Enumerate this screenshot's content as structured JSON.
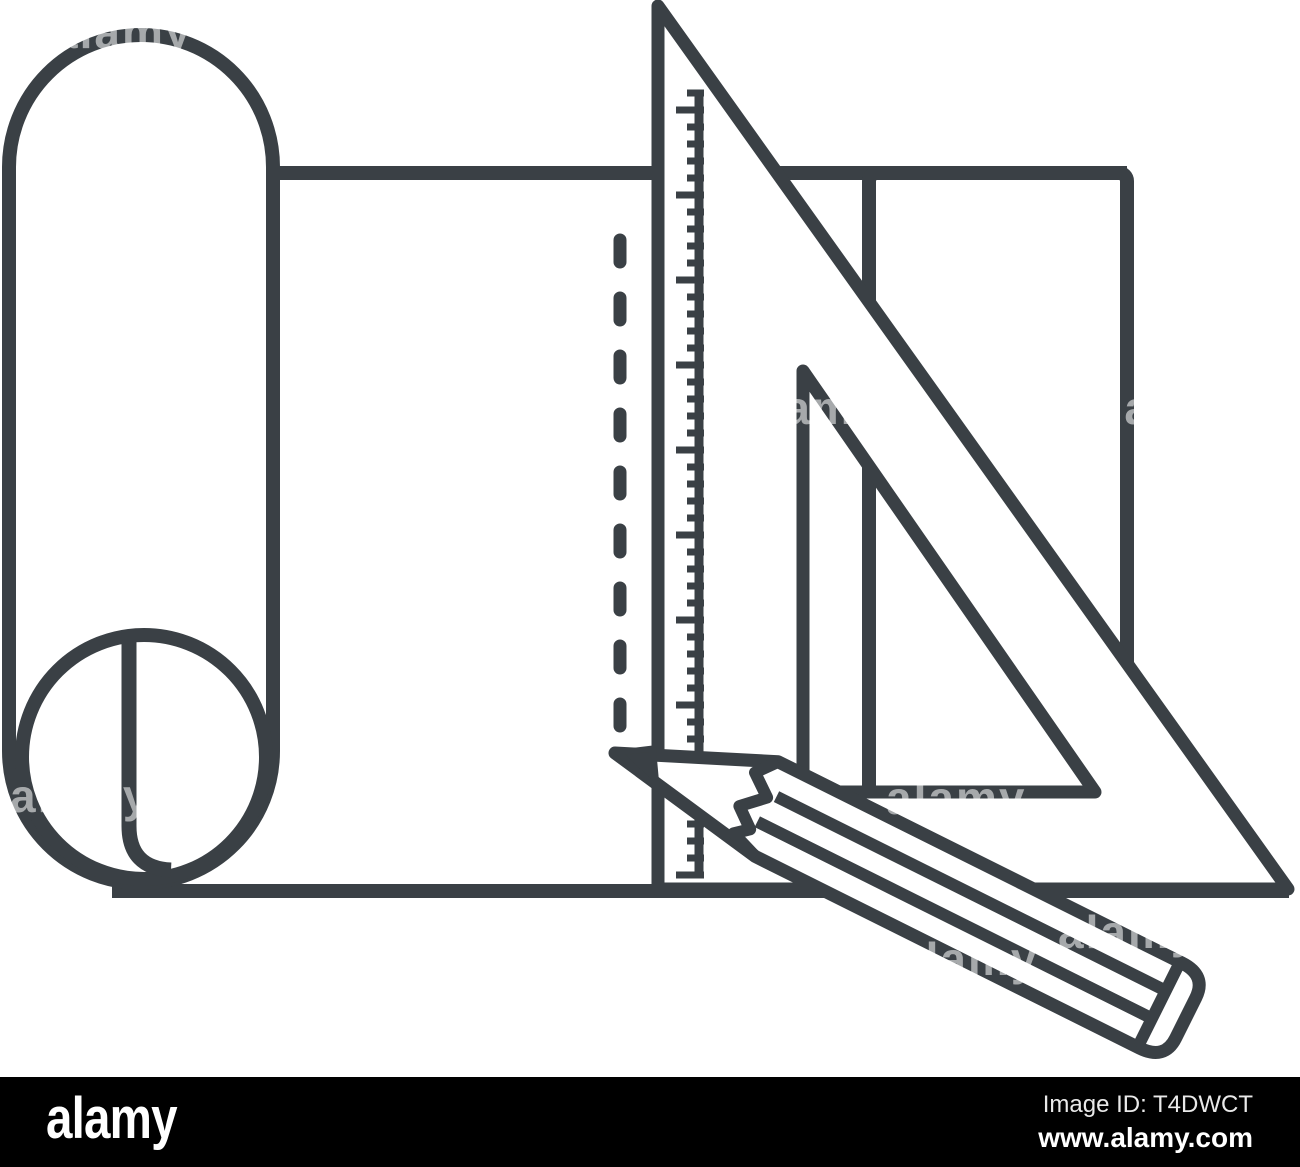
{
  "canvas": {
    "width": 1300,
    "height": 1167
  },
  "colors": {
    "line_color": "#3a4045",
    "background": "#ffffff",
    "footer_background": "#000000",
    "footer_text": "#ffffff",
    "image_id_text": "#e9e9e9"
  },
  "illustration": {
    "description": "black-and-white line-art icon of a rolled drawing sheet with ruler scale, set-square triangle and pencil",
    "elements": [
      "paper-roll",
      "sheet",
      "fold-dashed-line",
      "ruler-scale",
      "set-square",
      "board-rectangle",
      "pencil"
    ]
  },
  "watermark": {
    "text": "alamy"
  },
  "footer": {
    "logo_text": "alamy",
    "image_id_label": "Image ID:",
    "image_id_value": "T4DWCT",
    "website": "www.alamy.com"
  }
}
